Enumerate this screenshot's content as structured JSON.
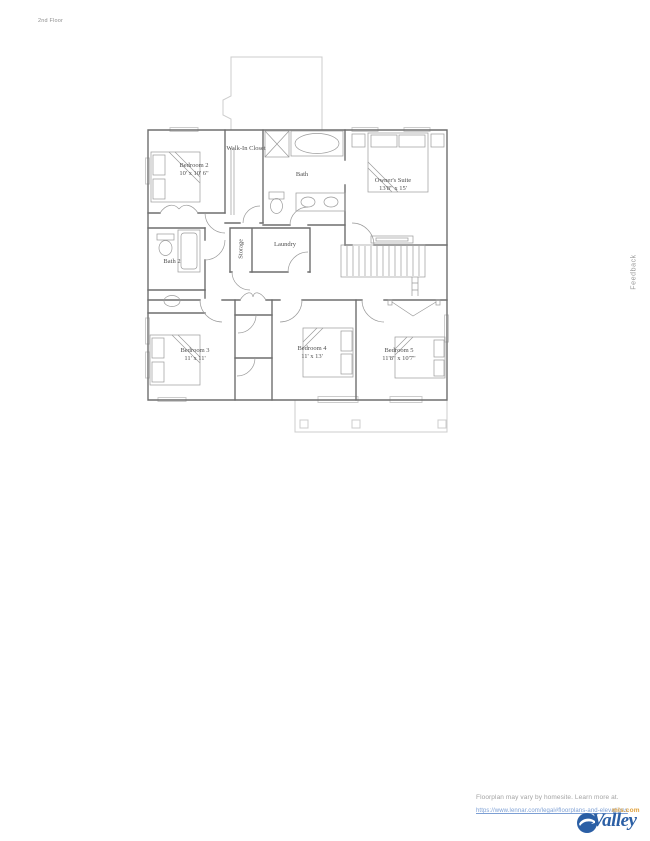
{
  "page": {
    "floor_label": "2nd Floor",
    "feedback_label": "Feedback"
  },
  "floorplan": {
    "rooms": {
      "bedroom2": {
        "name": "Bedroom 2",
        "dims": "10' x 10' 6\""
      },
      "walkin": {
        "name": "Walk-In Closet",
        "dims": ""
      },
      "bath": {
        "name": "Bath",
        "dims": ""
      },
      "owners": {
        "name": "Owner's Suite",
        "dims": "13'8\" x 15'"
      },
      "bath2": {
        "name": "Bath 2",
        "dims": ""
      },
      "storage": {
        "name": "Storage",
        "dims": ""
      },
      "laundry": {
        "name": "Laundry",
        "dims": ""
      },
      "bedroom3": {
        "name": "Bedroom 3",
        "dims": "11' x 11'"
      },
      "bedroom4": {
        "name": "Bedroom 4",
        "dims": "11' x 13'"
      },
      "bedroom5": {
        "name": "Bedroom 5",
        "dims": "11'8\" x 10'7\""
      }
    }
  },
  "footer": {
    "disclaimer": "Floorplan may vary by homesite. Learn more at.",
    "link": "https://www.lennar.com/legal#floorplans-and-elevations",
    "logo": {
      "name": "Valley",
      "suffix": "mls.com"
    }
  },
  "colors": {
    "wall": "#6e6e6e",
    "fixture": "#9a9a9a",
    "light_outline": "#cccccc",
    "label_text": "#4f4f4f",
    "link_blue": "#7c9fd4",
    "logo_blue": "#2b5fa5",
    "logo_orange": "#e0a23e",
    "muted_text": "#a3a3a3"
  }
}
